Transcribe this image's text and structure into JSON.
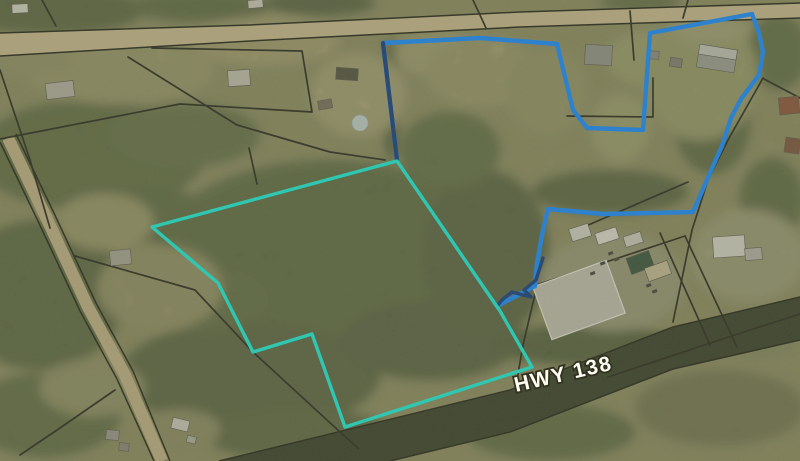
{
  "map": {
    "road_label": "HWY 138",
    "colors": {
      "subject_parcel_outline": "#2fc7b2",
      "adjacent_parcel_outline": "#2e82cd",
      "adjacent_parcel_shadowed_edge": "#2b4a74",
      "parcel_boundary_lines": "#1c1c14",
      "road_label_text": "#fdfdf3",
      "road_label_halo": "#32321f"
    },
    "parcels": {
      "subject": {
        "outline": "152,227 397,161 500,311 532,367 345,427 312,334 253,352 218,283"
      },
      "adjacent": {
        "outline": "397,160 383,43 480,38 557,44 573,110 587,128 643,130 650,33 752,14 759,33 763,52 759,75 750,87 741,99 731,118 722,146 713,166 700,196 693,212 603,214 548,209 543,230 537,263 535,286 497,306",
        "west_edge": "397,160 383,43",
        "tail_scribble": "543,258 536,280 524,290 531,297 512,292 503,299 497,306"
      }
    },
    "roads": {
      "top_road": {
        "band": "0,33 250,25 520,12 800,3 800,18 520,27 250,41 0,56",
        "edge_upper": "0,33 250,25 520,12 800,3",
        "edge_lower": "0,56 250,41 520,27 800,18"
      },
      "hwy138": {
        "band": "219,461 510,390 673,327 800,297 800,340 673,369 510,432 390,461",
        "edge_upper": "219,461 510,390 673,327 800,297",
        "edge_lower": "390,461 510,432 673,369 800,340"
      },
      "lane": {
        "center": "8,138 45,215 88,307 125,375 162,461",
        "edge_left": "0,142 37,219 80,311 117,379 154,461",
        "edge_right": "16,134 53,211 96,303 133,371 170,461"
      }
    },
    "boundaries": [
      "42,0 56,26",
      "0,70 30,160 50,228",
      "152,48 302,51 312,112 180,104 0,139",
      "249,148 257,184",
      "473,0 486,28",
      "567,116 653,117 653,78",
      "630,11 634,60",
      "688,0 683,18",
      "763,78 728,140 708,180 692,230 673,322",
      "764,79 800,98",
      "685,236 530,287",
      "660,233 710,345",
      "685,236 737,347",
      "572,232 688,182",
      "75,256 195,290 253,352 340,432 358,448",
      "115,390 60,428 20,455",
      "536,290 523,345 516,386",
      "608,377 750,330 800,314",
      "128,57 237,125 330,152 385,160"
    ]
  }
}
